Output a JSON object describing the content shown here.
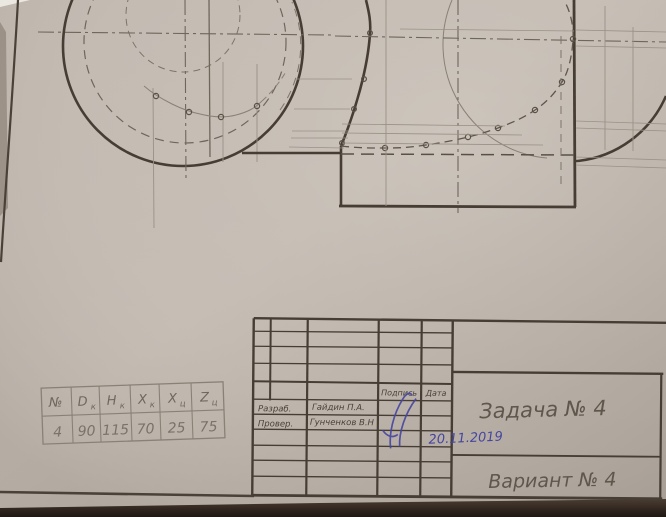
{
  "drawing": {
    "parameter_table": {
      "headers": [
        {
          "main": "№",
          "sub": ""
        },
        {
          "main": "D",
          "sub": "к"
        },
        {
          "main": "H",
          "sub": "к"
        },
        {
          "main": "X",
          "sub": "к"
        },
        {
          "main": "X",
          "sub": "ц"
        },
        {
          "main": "Z",
          "sub": "ц"
        }
      ],
      "values": [
        "4",
        "90",
        "115",
        "70",
        "25",
        "75"
      ]
    },
    "title_block": {
      "developed_label": "Разраб.",
      "developed_name": "Гайдин П.А.",
      "checked_label": "Провер.",
      "checked_name": "Гунченков В.Н",
      "signature_header": "Подпись",
      "date_header": "Дата",
      "date_value": "20.11.2019",
      "task_title": "Задача № 4",
      "variant_title": "Вариант № 4"
    },
    "colors": {
      "paper": "#bfb7ae",
      "thick_line": "#463d34",
      "thin_line": "#9a9186",
      "center_line": "#6f665c",
      "pencil_text": "#6f665c",
      "ink_blue": "#4646a0"
    }
  }
}
